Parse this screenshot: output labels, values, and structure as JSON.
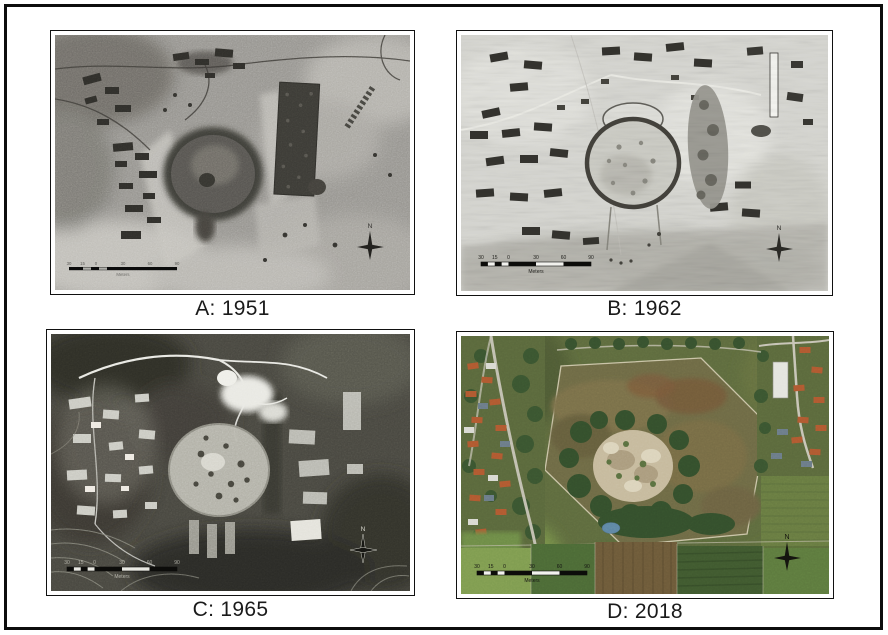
{
  "figure": {
    "panels": [
      {
        "id": "A",
        "caption": "A: 1951"
      },
      {
        "id": "B",
        "caption": "B: 1962"
      },
      {
        "id": "C",
        "caption": "C: 1965"
      },
      {
        "id": "D",
        "caption": "D: 2018"
      }
    ],
    "scalebar": {
      "ticks": [
        "30",
        "15",
        "0",
        "30",
        "60",
        "90"
      ],
      "unit": "Meters"
    },
    "north": {
      "label": "N"
    }
  },
  "colors": {
    "page_background": "#ffffff",
    "outer_border": "#0d0d0d",
    "panel_border": "#111111",
    "caption_text": "#1a1a1a",
    "photo_a_base": "#96948f",
    "photo_b_base": "#d9d9d4",
    "photo_c_base": "#47463f",
    "photo_d_field": "#6e6a45",
    "photo_d_mound": "#c6ba9d",
    "photo_d_trees": "#344f2c",
    "photo_d_roof_orange": "#b05930",
    "photo_d_pond": "#5e86a4"
  }
}
